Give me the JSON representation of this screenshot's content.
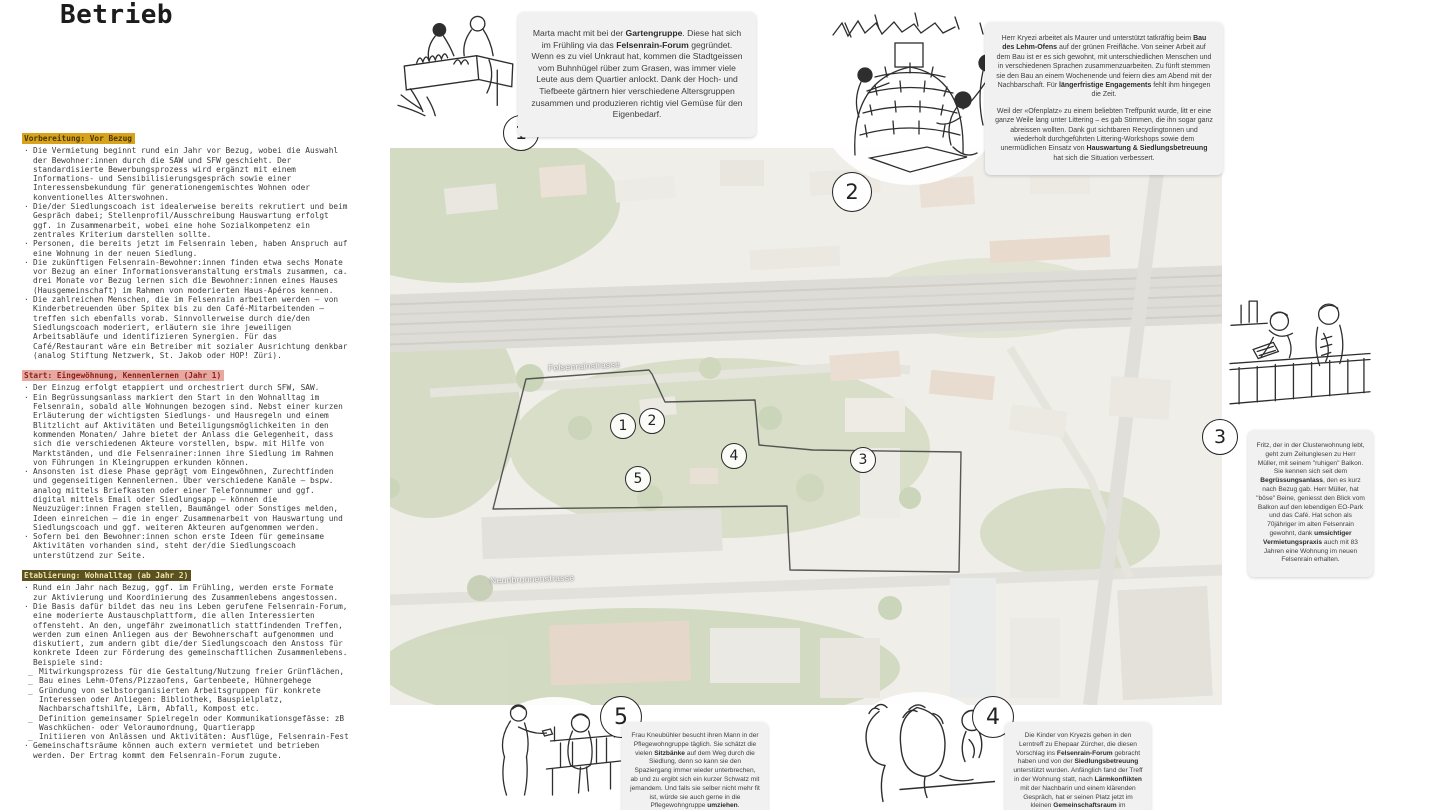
{
  "title": "Betrieb",
  "colors": {
    "header_gold_bg": "#d7a21c",
    "header_rose_bg": "#e7a8a1",
    "header_olive_bg": "#5a5120",
    "story_box_bg": "#f1f1f1",
    "ink": "#2a2a2a"
  },
  "left_column": {
    "sections": [
      {
        "style": "gold",
        "header": "Vorbereitung: Vor Bezug",
        "items": [
          {
            "m": "·",
            "t": "Die Vermietung beginnt rund ein Jahr vor Bezug, wobei die Auswahl der Bewohner:innen durch die SAW und SFW geschieht. Der standardisierte Bewerbungsprozess wird ergänzt mit einem Informations- und Sensibilisierungsgespräch sowie einer Interessensbekundung für generationengemischtes Wohnen oder konventionelles Alterswohnen."
          },
          {
            "m": "·",
            "t": "Die/der Siedlungscoach ist idealerweise bereits rekrutiert und beim Gespräch dabei; Stellenprofil/Ausschreibung Hauswartung erfolgt ggf. in Zusammenarbeit, wobei eine hohe Sozialkompetenz ein zentrales Kriterium darstellen sollte."
          },
          {
            "m": "·",
            "t": "Personen, die bereits jetzt im Felsenrain leben, haben Anspruch auf eine Wohnung in der neuen Siedlung."
          },
          {
            "m": "·",
            "t": "Die zukünftigen Felsenrain-Bewohner:innen finden etwa sechs Monate vor Bezug an einer Informationsveranstaltung erstmals zusammen, ca. drei Monate vor Bezug lernen sich die Bewohner:innen eines Hauses (Hausgemeinschaft) im Rahmen von moderierten Haus-Apéros kennen."
          },
          {
            "m": "·",
            "t": "Die zahlreichen Menschen, die im Felsenrain arbeiten werden – von Kinderbetreuenden über Spitex bis zu den Café-Mitarbeitenden – treffen sich ebenfalls vorab. Sinnvollerweise durch die/den Siedlungscoach moderiert, erläutern sie ihre jeweiligen Arbeitsabläufe und identifizieren Synergien. Für das Café/Restaurant wäre ein Betreiber mit sozialer Ausrichtung denkbar (analog Stiftung Netzwerk, St. Jakob oder HOP! Züri)."
          }
        ]
      },
      {
        "style": "rose",
        "header": "Start: Eingewöhnung, Kennenlernen (Jahr 1)",
        "items": [
          {
            "m": "·",
            "t": "Der Einzug erfolgt etappiert und orchestriert durch SFW, SAW."
          },
          {
            "m": "·",
            "t": "Ein Begrüssungsanlass markiert den Start in den Wohnalltag im Felsenrain, sobald alle Wohnungen bezogen sind. Nebst einer kurzen Erläuterung der wichtigsten Siedlungs- und Hausregeln und einem Blitzlicht auf Aktivitäten und Beteiligungsmöglichkeiten in den kommenden Monaten/ Jahre bietet der Anlass die Gelegenheit, dass sich die verschiedenen Akteure vorstellen, bspw. mit Hilfe von Marktständen, und die Felsenrainer:innen ihre Siedlung im Rahmen von Führungen in Kleingruppen erkunden können."
          },
          {
            "m": "·",
            "t": "Ansonsten ist diese Phase geprägt vom Eingewöhnen, Zurechtfinden und gegenseitigen Kennenlernen. Über verschiedene Kanäle – bspw. analog mittels Briefkasten oder einer Telefonnummer und ggf. digital mittels Email oder Siedlungsapp – können die Neuzuzüger:innen Fragen stellen, Baumängel oder Sonstiges melden, Ideen einreichen – die in enger Zusammenarbeit von Hauswartung und Siedlungscoach und ggf. weiteren Akteuren aufgenommen werden."
          },
          {
            "m": "·",
            "t": "Sofern bei den Bewohner:innen schon erste Ideen für gemeinsame Aktivitäten vorhanden sind, steht der/die Siedlungscoach unterstützend zur Seite."
          }
        ]
      },
      {
        "style": "olive",
        "header": "Etablierung: Wohnalltag (ab Jahr 2)",
        "items": [
          {
            "m": "·",
            "t": "Rund ein Jahr nach Bezug, ggf. im Frühling, werden erste Formate zur Aktivierung und Koordinierung des Zusammenlebens angestossen."
          },
          {
            "m": "·",
            "t": "Die Basis dafür bildet das neu ins Leben gerufene Felsenrain-Forum, eine moderierte Austauschplattform, die allen Interessierten offensteht. An den, ungefähr zweimonatlich stattfindenden Treffen, werden zum einen Anliegen aus der Bewohnerschaft aufgenommen und diskutiert, zum andern gibt die/der Siedlungscoach den Anstoss für konkrete Ideen zur Förderung des gemeinschaftlichen Zusammenlebens. Beispiele sind:"
          },
          {
            "m": "_",
            "t": "Mitwirkungsprozess für die Gestaltung/Nutzung freier Grünflächen,"
          },
          {
            "m": "_",
            "t": "Bau eines Lehm-Ofens/Pizzaofens, Gartenbeete, Hühnergehege"
          },
          {
            "m": "_",
            "t": "Gründung von selbstorganisierten Arbeitsgruppen für konkrete Interessen oder Anliegen: Bibliothek, Bauspielplatz, Nachbarschaftshilfe, Lärm, Abfall, Kompost etc."
          },
          {
            "m": "_",
            "t": "Definition gemeinsamer Spielregeln oder Kommunikationsgefässe: zB Waschküchen- oder Veloraumordnung, Quartierapp"
          },
          {
            "m": "_",
            "t": "Initiieren von Anlässen und Aktivitäten: Ausflüge, Felsenrain-Fest"
          },
          {
            "m": "·",
            "t": "Gemeinschaftsräume können auch extern vermietet und betrieben werden. Der Ertrag kommt dem Felsenrain-Forum zugute."
          }
        ]
      }
    ]
  },
  "map": {
    "street_labels": [
      {
        "text": "Felsenrainstrasse",
        "x": 158,
        "y": 213,
        "angle": -3
      },
      {
        "text": "Neunbrunnenstrasse",
        "x": 100,
        "y": 426,
        "angle": -2
      }
    ],
    "site_numbers": [
      {
        "n": "1",
        "x": 233,
        "y": 278
      },
      {
        "n": "2",
        "x": 262,
        "y": 273
      },
      {
        "n": "4",
        "x": 344,
        "y": 308
      },
      {
        "n": "5",
        "x": 248,
        "y": 331
      },
      {
        "n": "3",
        "x": 473,
        "y": 312
      }
    ]
  },
  "vignettes": {
    "v1": {
      "n": "1",
      "icon": "gardening-raised-bed-sketch"
    },
    "v2": {
      "n": "2",
      "icon": "clay-oven-build-sketch"
    },
    "v3": {
      "n": "3",
      "icon": "balcony-newspaper-sketch"
    },
    "v4": {
      "n": "4",
      "icon": "children-lerntreff-sketch"
    },
    "v5": {
      "n": "5",
      "icon": "bench-chat-sketch"
    }
  },
  "stories": {
    "s1": {
      "paragraphs": [
        [
          {
            "t": "Marta macht mit bei der "
          },
          {
            "t": "Gartengruppe",
            "b": 1
          },
          {
            "t": ". Diese hat sich im Frühling via das "
          },
          {
            "t": "Felsenrain-Forum",
            "b": 1
          },
          {
            "t": " gegründet. Wenn es zu viel Unkraut hat, kommen die Stadtgeissen vom Buhnhügel rüber zum Grasen, was immer viele Leute aus dem Quartier anlockt. Dank der Hoch- und Tiefbeete gärtnern hier verschiedene Altersgruppen zusammen und produzieren richtig viel Gemüse für den Eigenbedarf."
          }
        ]
      ]
    },
    "s2": {
      "paragraphs": [
        [
          {
            "t": "Herr Kryezi arbeitet als Maurer und unterstützt tatkräftig beim "
          },
          {
            "t": "Bau des Lehm-Ofens",
            "b": 1
          },
          {
            "t": " auf der grünen Freifläche. Von seiner Arbeit auf dem Bau ist er es sich gewohnt, mit unterschiedlichen Menschen und in verschiedenen Sprachen zusammenzuarbeiten. Zu fünft stemmen sie den Bau an einem Wochenende und feiern dies am Abend mit der Nachbarschaft. Für "
          },
          {
            "t": "längerfristige Engagements",
            "b": 1
          },
          {
            "t": " fehlt ihm hingegen die Zeit."
          }
        ],
        [
          {
            "t": "Weil der «Ofenplatz» zu einem beliebten Treffpunkt wurde, litt er eine ganze Weile lang unter Littering – es gab Stimmen, die ihn sogar ganz abreissen wollten. Dank gut sichtbaren Recyclingtonnen und wiederholt durchgeführten Littering-Workshops sowie dem unermüdlichen Einsatz von "
          },
          {
            "t": "Hauswartung & Siedlungsbetreuung",
            "b": 1
          },
          {
            "t": " hat sich die Situation verbessert."
          }
        ]
      ]
    },
    "s3": {
      "paragraphs": [
        [
          {
            "t": "Fritz, der in der Clusterwohnung lebt, geht zum Zeitunglesen zu Herr Müller, mit seinem \"ruhigen\" Balkon. Sie kennen sich seit dem "
          },
          {
            "t": "Begrüssungsanlass",
            "b": 1
          },
          {
            "t": ", den es kurz nach Bezug gab. Herr Müller, hat \"böse\" Beine, geniesst den Blick vom Balkon auf den lebendigen EO-Park und das Café. Hat schon als 70jähriger im alten Felsenrain gewohnt, dank "
          },
          {
            "t": "umsichtiger Vermietungspraxis",
            "b": 1
          },
          {
            "t": " auch mit 83 Jahren eine Wohnung im neuen Felsenrain erhalten."
          }
        ]
      ]
    },
    "s4": {
      "paragraphs": [
        [
          {
            "t": "Die Kinder von Kryezis gehen in den Lerntreff zu Ehepaar Zürcher, die diesen Vorschlag ins "
          },
          {
            "t": "Felsenrain-Forum",
            "b": 1
          },
          {
            "t": " gebracht haben und von der "
          },
          {
            "t": "Siedlungsbetreuung",
            "b": 1
          },
          {
            "t": " unterstützt wurden. Anfänglich fand der Treff in der Wohnung statt, nach "
          },
          {
            "t": "Lärmkonflikten",
            "b": 1
          },
          {
            "t": " mit der Nachbarin und einem klärenden Gespräch, hat er seinen Platz jetzt im kleinen "
          },
          {
            "t": "Gemeinschaftsraum",
            "b": 1
          },
          {
            "t": " im Erdgeschoss."
          }
        ]
      ]
    },
    "s5": {
      "paragraphs": [
        [
          {
            "t": "Frau Kneubühler besucht ihren Mann in der Pflegewohngruppe täglich. Sie schätzt die vielen "
          },
          {
            "t": "Sitzbänke",
            "b": 1
          },
          {
            "t": " auf dem Weg durch die Siedlung, denn so kann sie den Spaziergang immer wieder unterbrechen, ab und zu ergibt sich ein kurzer Schwatz mit jemandem. Und falls sie selber nicht mehr fit ist, würde sie auch gerne in die Pflegewohngruppe "
          },
          {
            "t": "umziehen",
            "b": 1
          },
          {
            "t": "."
          }
        ]
      ]
    }
  }
}
